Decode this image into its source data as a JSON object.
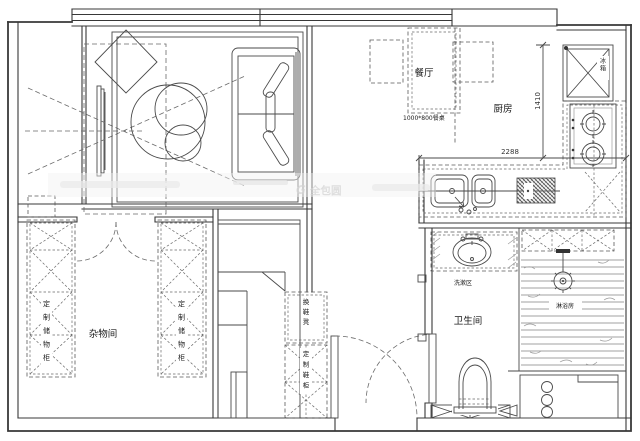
{
  "title": "apartment-floor-plan",
  "rooms": {
    "dining": "餐厅",
    "kitchen": "厨房",
    "bathroom": "卫生间",
    "storage": "杂物间",
    "wash_area": "洗漱区",
    "shower": "淋浴房"
  },
  "furniture": {
    "dining_table": "1000*800餐桌",
    "fridge": "冰箱",
    "shoe_bench": "换鞋凳",
    "shoe_cabinet": "定制鞋柜",
    "storage_cabinet_left": "定制储物柜",
    "storage_cabinet_right": "定制储物柜"
  },
  "dimensions": {
    "counter_width": "2288",
    "counter_depth": "1410"
  },
  "watermark": {
    "logo": "G",
    "brand": "全包圆"
  },
  "colors": {
    "line": "#4a4a4a",
    "wall": "#383838",
    "background": "#ffffff",
    "watermark": "#d9d9d9"
  }
}
